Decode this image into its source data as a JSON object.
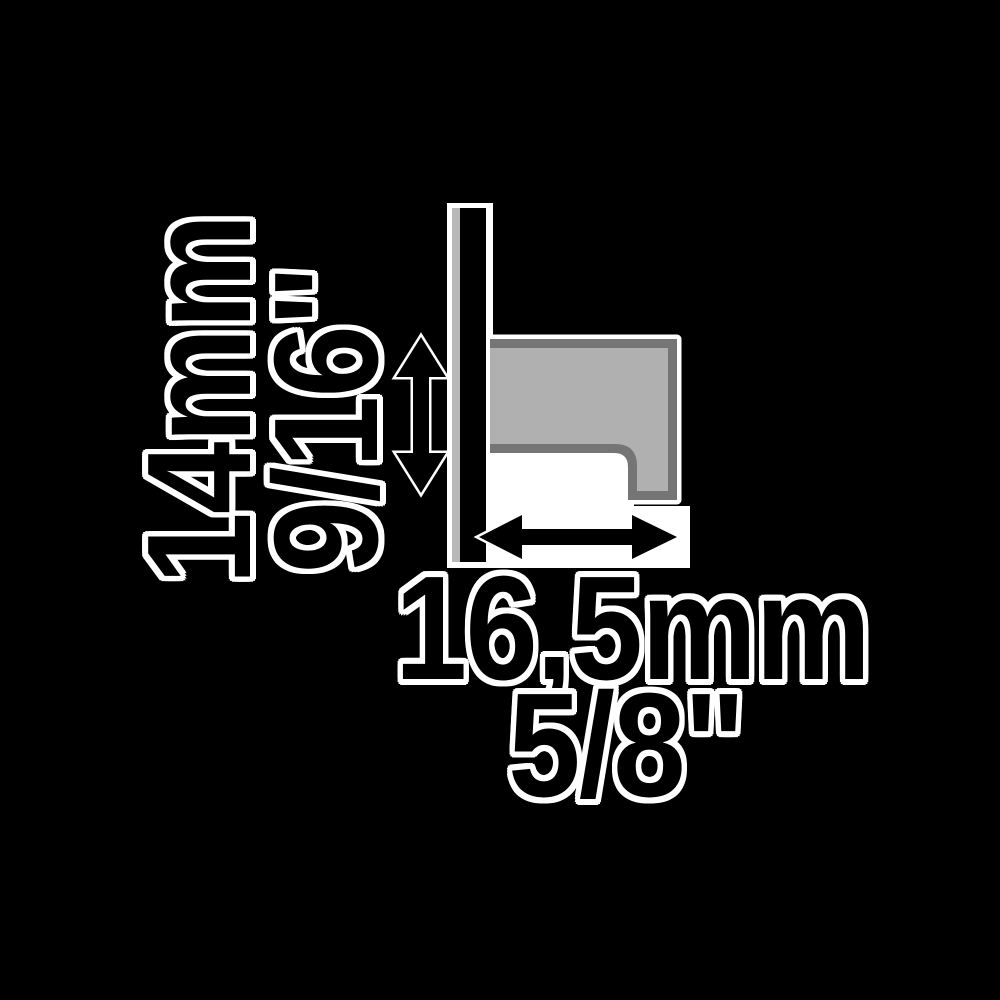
{
  "diagram": {
    "description": "Technical dimension drawing of a trim profile cross-section holding a panel",
    "background_color": "#000000",
    "labels": {
      "height_mm": "14mm",
      "height_inch": "9/16\"",
      "width_mm": "16,5mm",
      "width_inch": "5/8\""
    },
    "dimensions": [
      {
        "axis": "vertical",
        "value_mm": "14mm",
        "value_inch": "9/16\""
      },
      {
        "axis": "horizontal",
        "value_mm": "16,5mm",
        "value_inch": "5/8\""
      }
    ],
    "icons": {
      "vertical_arrow": "double-arrow-vertical-icon",
      "horizontal_arrow": "double-arrow-horizontal-icon"
    },
    "colors": {
      "line_and_text": "#000000",
      "halo": "#ffffff",
      "profile_border": "#757575",
      "profile_fill": "#b0b0b0",
      "panel_bar": "#000000",
      "panel_shadow": "#b8b8b8"
    }
  }
}
